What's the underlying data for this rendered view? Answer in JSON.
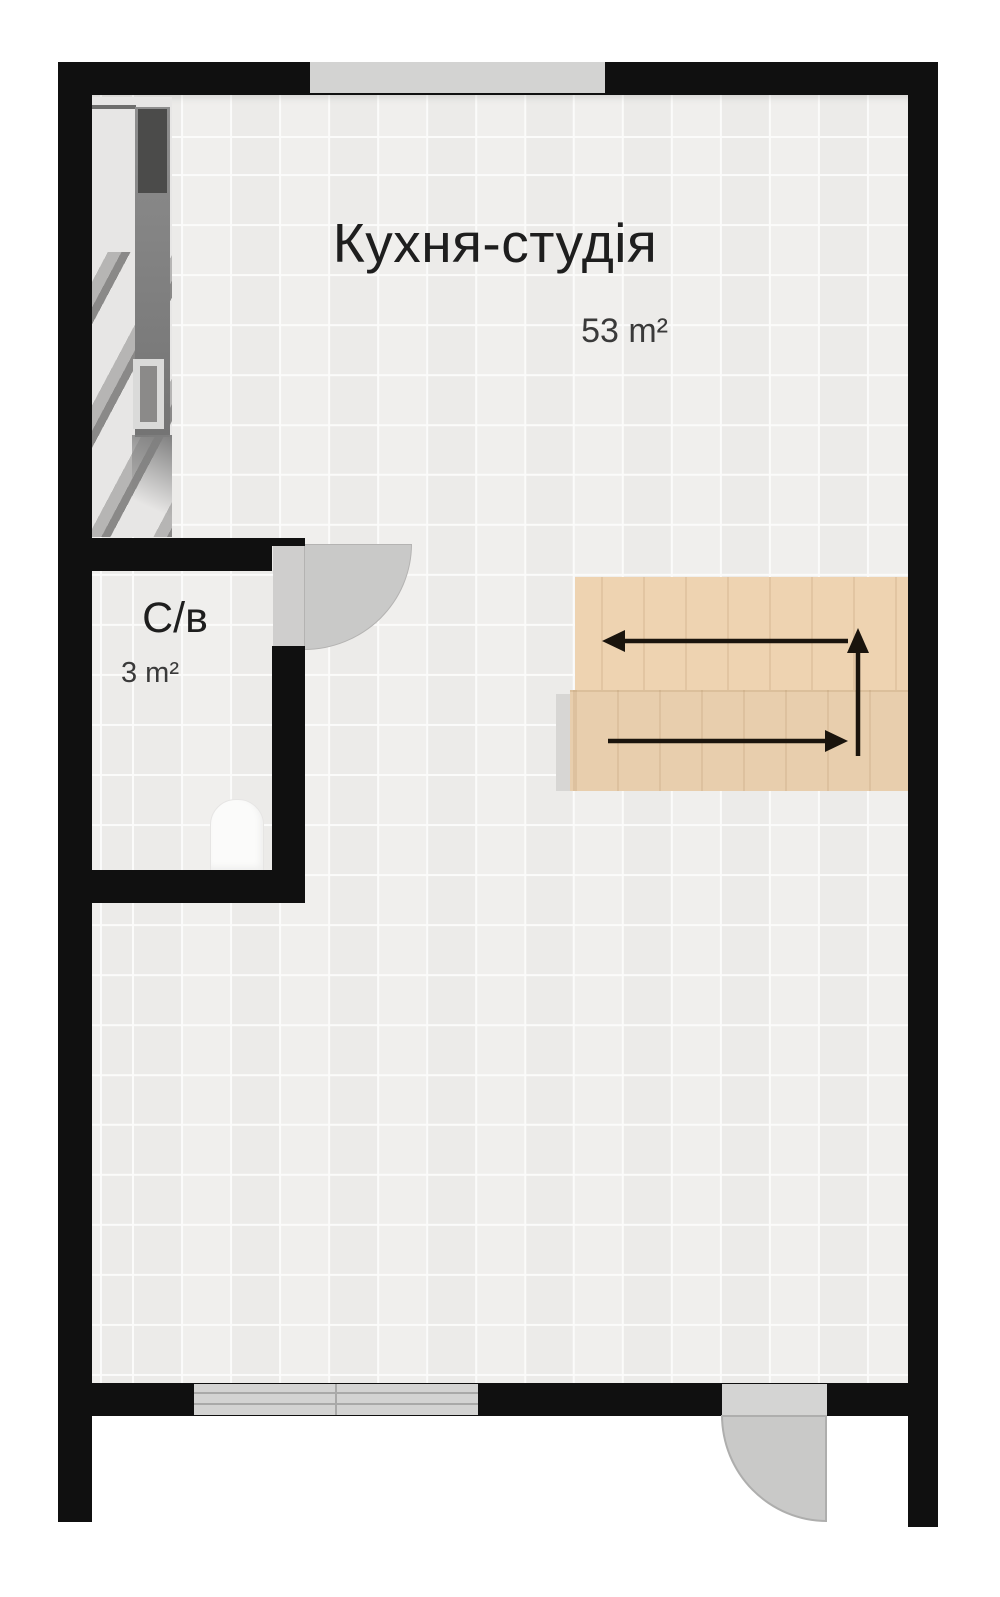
{
  "plan": {
    "rooms": [
      {
        "name": "Кухня-студія",
        "area": "53 m²"
      },
      {
        "name": "С/в",
        "area": "3 m²"
      }
    ]
  },
  "features": {
    "stairs": {
      "flights": 2,
      "arrow_directions": [
        "left",
        "up",
        "right"
      ]
    },
    "doors": [
      "bathroom-door",
      "entry-door"
    ],
    "windows": [
      "top-window",
      "bottom-window"
    ],
    "fixtures": [
      "toilet"
    ]
  },
  "colors": {
    "wall": "#101010",
    "floor": "#f0efed",
    "grid": "#fbfbfa",
    "outside": "#ffffff",
    "stairs_upper": "#eed3b1",
    "stairs_lower": "#e8cead",
    "door_swing": "#c9c9c8",
    "window_glass": "#d3d3d2",
    "arrow": "#1a140d",
    "text_primary": "#1e1e1e",
    "text_secondary": "#3a3a3a"
  }
}
